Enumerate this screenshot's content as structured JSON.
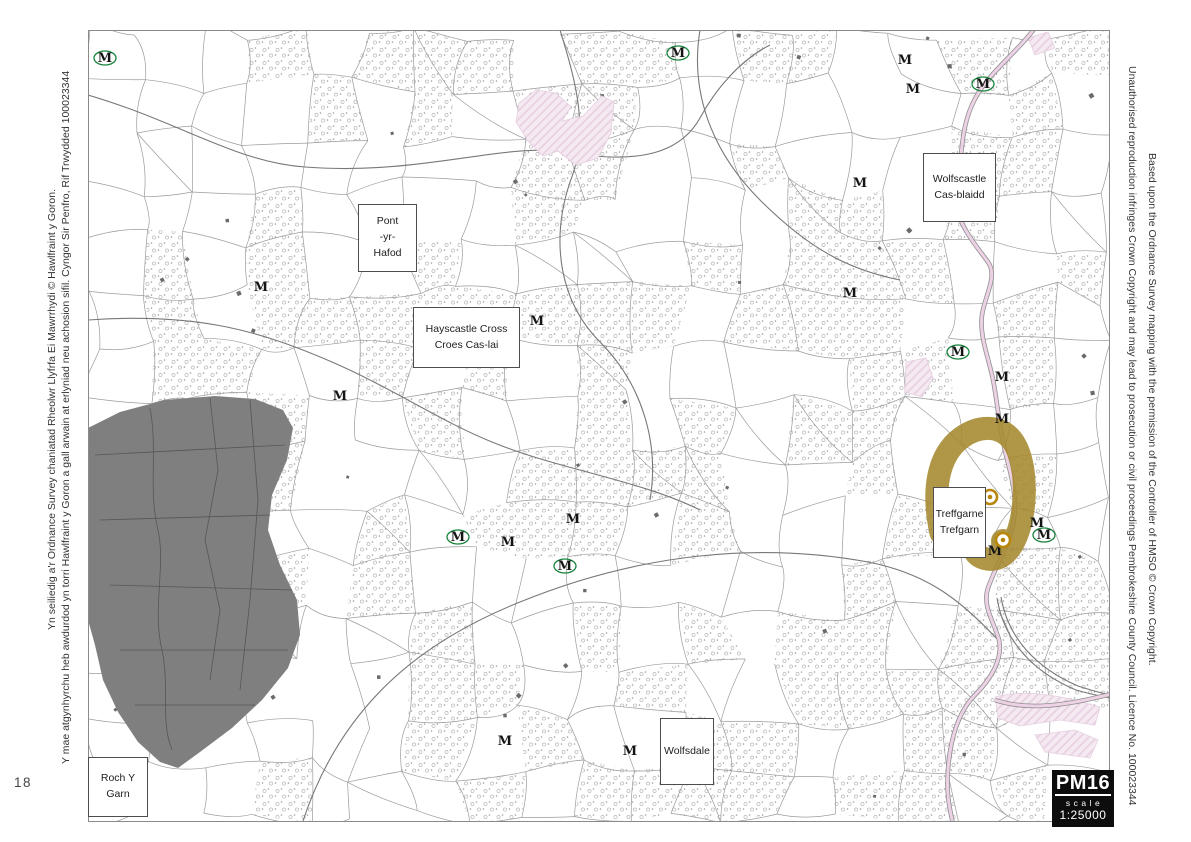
{
  "page": {
    "number": "18",
    "credits": {
      "left_line1": "Yn seiliedig a'r Ordnance Survey chaniatad Rheolwr Llyfrfa Ei Mawrrhydi © Hawlfraint y Goron.",
      "left_line2": "Y mae atgynhyrchu heb awdurdod yn torri Hawlfraint y Goron a gall arwain at erlyniad neu achosion sifil. Cyngor Sir Penfro, Rif Trwydded 100023344",
      "right_line1": "Based upon the Ordnance Survey mapping with the permission of the Controller of HMSO © Crown Copyright.",
      "right_line2": "Unauthorised reproduction infringes Crown Copyright and may lead to prosecution or civil proceedings Pembrokeshire County Council. Licence No. 100023344"
    }
  },
  "map": {
    "sheet_ref": "PM16",
    "scale_label": "scale",
    "scale_value": "1:25000",
    "monument_glyph": "M",
    "labels": [
      {
        "id": "pont-yr-hafod",
        "lines": [
          "Pont",
          "-yr-",
          "Hafod"
        ],
        "x": 358,
        "y": 204,
        "w": 59,
        "h": 68
      },
      {
        "id": "hayscastle-cross",
        "lines": [
          "Hayscastle Cross",
          "Croes Cas-lai"
        ],
        "x": 413,
        "y": 307,
        "w": 107,
        "h": 61
      },
      {
        "id": "wolfscastle",
        "lines": [
          "Wolfscastle",
          "Cas-blaidd"
        ],
        "x": 923,
        "y": 153,
        "w": 73,
        "h": 69
      },
      {
        "id": "treffgarne",
        "lines": [
          "Treffgarne",
          "Trefgarn"
        ],
        "x": 933,
        "y": 487,
        "w": 53,
        "h": 71
      },
      {
        "id": "wolfsdale",
        "lines": [
          "Wolfsdale"
        ],
        "x": 660,
        "y": 718,
        "w": 54,
        "h": 67
      },
      {
        "id": "roch-y-garn",
        "lines": [
          "Roch Y Garn"
        ],
        "x": 88,
        "y": 757,
        "w": 60,
        "h": 60
      }
    ],
    "monuments": [
      {
        "x": 105,
        "y": 62,
        "ring": true
      },
      {
        "x": 678,
        "y": 57,
        "ring": true
      },
      {
        "x": 905,
        "y": 64,
        "ring": false
      },
      {
        "x": 913,
        "y": 93,
        "ring": false
      },
      {
        "x": 983,
        "y": 88,
        "ring": true
      },
      {
        "x": 860,
        "y": 187,
        "ring": false
      },
      {
        "x": 261,
        "y": 291,
        "ring": false
      },
      {
        "x": 850,
        "y": 297,
        "ring": false
      },
      {
        "x": 537,
        "y": 325,
        "ring": false
      },
      {
        "x": 958,
        "y": 356,
        "ring": true
      },
      {
        "x": 1002,
        "y": 381,
        "ring": false
      },
      {
        "x": 340,
        "y": 400,
        "ring": false
      },
      {
        "x": 1002,
        "y": 423,
        "ring": false
      },
      {
        "x": 573,
        "y": 523,
        "ring": false
      },
      {
        "x": 458,
        "y": 541,
        "ring": true
      },
      {
        "x": 508,
        "y": 546,
        "ring": false
      },
      {
        "x": 565,
        "y": 570,
        "ring": true
      },
      {
        "x": 1037,
        "y": 527,
        "ring": false
      },
      {
        "x": 1044,
        "y": 539,
        "ring": true
      },
      {
        "x": 995,
        "y": 555,
        "ring": false
      },
      {
        "x": 505,
        "y": 745,
        "ring": false
      },
      {
        "x": 630,
        "y": 755,
        "ring": false
      }
    ],
    "heritage_sites": [
      {
        "x": 990,
        "y": 497
      },
      {
        "x": 1003,
        "y": 540
      }
    ],
    "colors": {
      "field_line": "#9b9b9b",
      "road_line": "#787878",
      "access_land_grey": "#7f7f7f",
      "heritage_gold": "#a5892e",
      "road_pink": "#ecd2e4",
      "area_pink": "#f5e9f2",
      "area_pink_line": "#e6cfe0",
      "monument_green": "#17823b",
      "target_gold": "#b8860b",
      "label_border": "#4d4d4d",
      "badge_bg": "#0d0d0d"
    }
  }
}
